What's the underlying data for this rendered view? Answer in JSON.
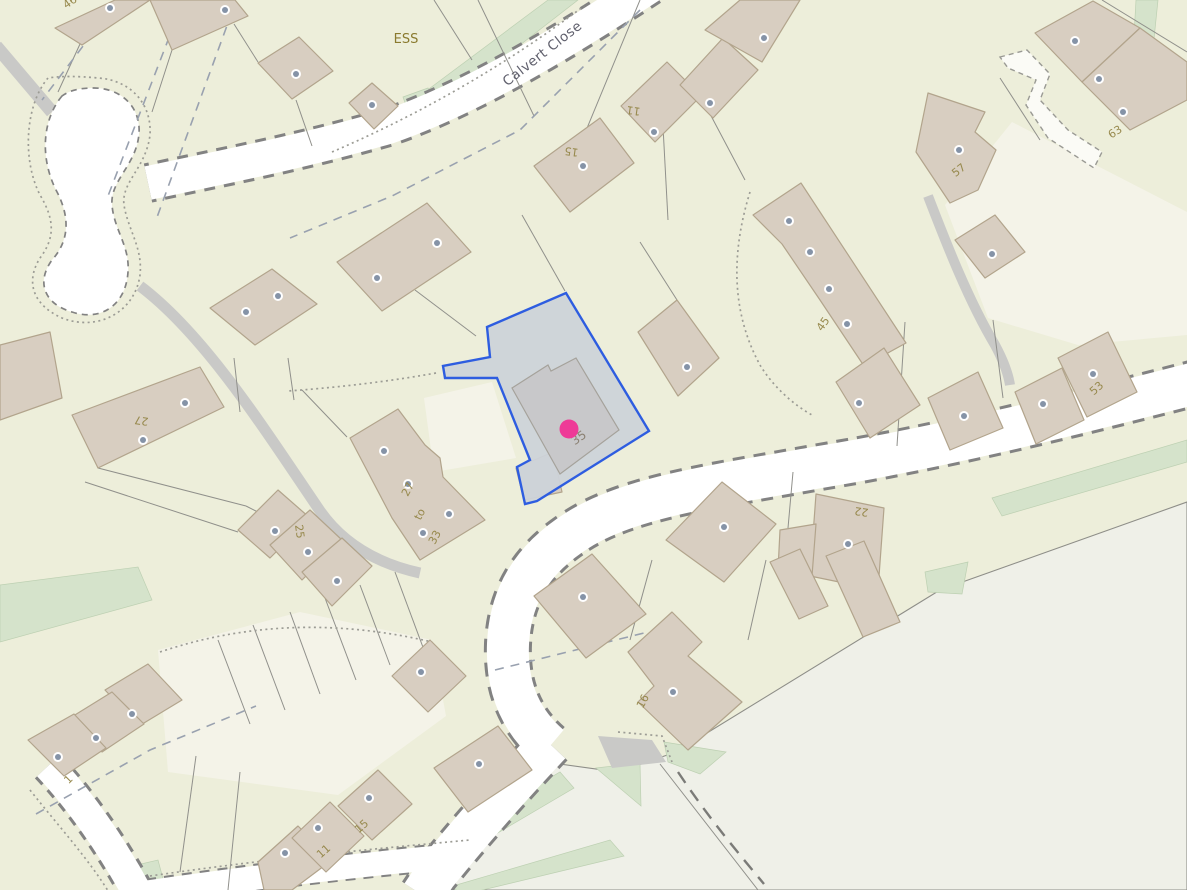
{
  "map": {
    "description": "Cadastral street map with selected parcel at 35 Calvert Close",
    "street_label": {
      "text": "Calvert Close",
      "x": 545,
      "y": 57,
      "rotation": -38
    },
    "area_label": {
      "text": "ESS",
      "x": 406,
      "y": 43
    },
    "selected_parcel": {
      "house_number_label": "35",
      "label_x": 581,
      "label_y": 441,
      "label_rotation": -35,
      "marker": {
        "x": 569,
        "y": 429,
        "radius": 9.5,
        "color": "#ee3a97"
      },
      "outline_color": "#2e5de0",
      "fill_color": "#cdd3d9"
    },
    "house_numbers": [
      {
        "text": "46",
        "x": 72,
        "y": 5,
        "rotation": -35
      },
      {
        "text": "15",
        "x": 572,
        "y": 148,
        "rotation": 188
      },
      {
        "text": "11",
        "x": 634,
        "y": 107,
        "rotation": 188
      },
      {
        "text": "63",
        "x": 1117,
        "y": 135,
        "rotation": -32
      },
      {
        "text": "57",
        "x": 961,
        "y": 173,
        "rotation": -38
      },
      {
        "text": "45",
        "x": 826,
        "y": 326,
        "rotation": -55
      },
      {
        "text": "53",
        "x": 1099,
        "y": 391,
        "rotation": -42
      },
      {
        "text": "27",
        "x": 142,
        "y": 417,
        "rotation": 188
      },
      {
        "text": "25",
        "x": 296,
        "y": 532,
        "rotation": 82
      },
      {
        "text": "27",
        "x": 411,
        "y": 491,
        "rotation": -62
      },
      {
        "text": "to",
        "x": 423,
        "y": 516,
        "rotation": -62
      },
      {
        "text": "33",
        "x": 438,
        "y": 539,
        "rotation": -62
      },
      {
        "text": "22",
        "x": 862,
        "y": 508,
        "rotation": 188
      },
      {
        "text": "16",
        "x": 646,
        "y": 703,
        "rotation": -62
      },
      {
        "text": "1",
        "x": 71,
        "y": 782,
        "rotation": -45
      },
      {
        "text": "11",
        "x": 326,
        "y": 854,
        "rotation": -42
      },
      {
        "text": "15",
        "x": 364,
        "y": 829,
        "rotation": -42
      }
    ],
    "entrance_dots": [
      [
        110,
        8
      ],
      [
        225,
        10
      ],
      [
        296,
        74
      ],
      [
        372,
        105
      ],
      [
        377,
        278
      ],
      [
        437,
        243
      ],
      [
        246,
        312
      ],
      [
        278,
        296
      ],
      [
        583,
        166
      ],
      [
        654,
        132
      ],
      [
        710,
        103
      ],
      [
        764,
        38
      ],
      [
        1075,
        41
      ],
      [
        1099,
        79
      ],
      [
        1123,
        112
      ],
      [
        959,
        150
      ],
      [
        992,
        254
      ],
      [
        789,
        221
      ],
      [
        810,
        252
      ],
      [
        829,
        289
      ],
      [
        847,
        324
      ],
      [
        859,
        403
      ],
      [
        964,
        416
      ],
      [
        1043,
        404
      ],
      [
        1093,
        374
      ],
      [
        687,
        367
      ],
      [
        384,
        451
      ],
      [
        408,
        484
      ],
      [
        449,
        514
      ],
      [
        423,
        533
      ],
      [
        185,
        403
      ],
      [
        143,
        440
      ],
      [
        275,
        531
      ],
      [
        308,
        552
      ],
      [
        337,
        581
      ],
      [
        132,
        714
      ],
      [
        96,
        738
      ],
      [
        58,
        757
      ],
      [
        285,
        853
      ],
      [
        318,
        828
      ],
      [
        369,
        798
      ],
      [
        421,
        672
      ],
      [
        479,
        764
      ],
      [
        583,
        597
      ],
      [
        673,
        692
      ],
      [
        848,
        544
      ],
      [
        724,
        527
      ]
    ],
    "colors": {
      "background": "#edeeda",
      "open_field": "#eff0e8",
      "building_fill": "#d8cec1",
      "building_stroke": "#b2a48c",
      "road_fill": "#ffffff",
      "road_casing": "#828282",
      "green_verge": "#d5e3cb",
      "driveway_gray": "#c9c9c7",
      "parking_cream": "#f4f3e8",
      "selection_fill": "#cdd3d9",
      "selection_outline": "#2e5de0",
      "marker_pink": "#ee3a97",
      "house_number_text": "#97894d",
      "street_text": "#60606d"
    }
  }
}
